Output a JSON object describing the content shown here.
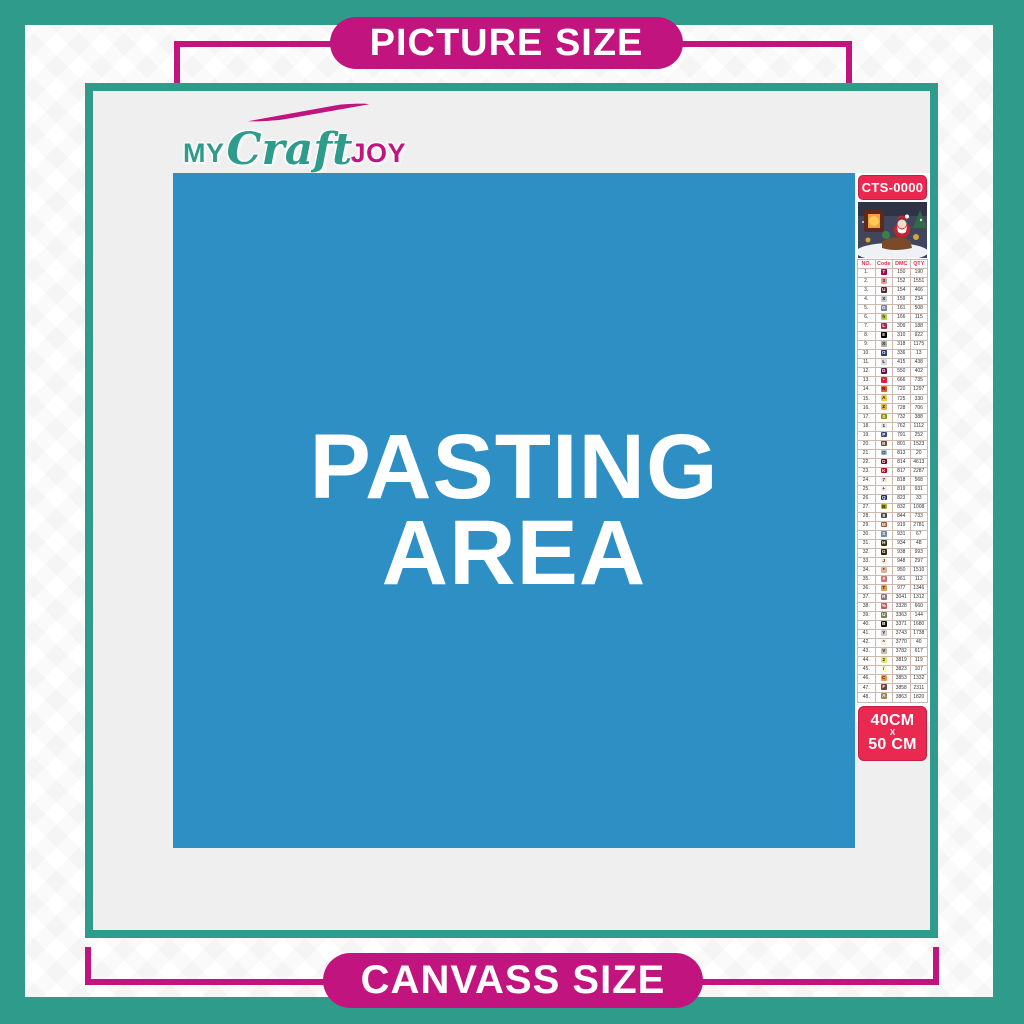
{
  "colors": {
    "teal": "#2F9B8B",
    "magenta": "#C2147E",
    "blue": "#2E8FC5",
    "red": "#E9294F",
    "canvas_gray": "#EFEFEF"
  },
  "banner_top": {
    "label": "PICTURE SIZE"
  },
  "banner_bottom": {
    "label": "CANVASS SIZE"
  },
  "logo": {
    "my": "MY",
    "craft": "Craft",
    "joy": "JOY"
  },
  "pasting": {
    "line1": "PASTING",
    "line2": "AREA"
  },
  "sidebar": {
    "sku": "CTS-0000",
    "size": {
      "width": "40CM",
      "sep": "X",
      "height": "50 CM"
    },
    "table": {
      "headers": [
        "NO.",
        "Code",
        "DMC",
        "QTY"
      ],
      "rows": [
        [
          "1.",
          "T",
          "#AB0249",
          "#ffffff",
          "150",
          "190"
        ],
        [
          "2.",
          "3",
          "#E2A099",
          "#222222",
          "152",
          "1551"
        ],
        [
          "3.",
          "U",
          "#572433",
          "#ffffff",
          "154",
          "466"
        ],
        [
          "4.",
          "X",
          "#C7CAD7",
          "#222222",
          "159",
          "234"
        ],
        [
          "5.",
          "G",
          "#7880A4",
          "#ffffff",
          "161",
          "508"
        ],
        [
          "6.",
          "h",
          "#C0C840",
          "#222222",
          "166",
          "115"
        ],
        [
          "7.",
          "L",
          "#9B2D4F",
          "#ffffff",
          "309",
          "188"
        ],
        [
          "8.",
          "E",
          "#000000",
          "#ffffff",
          "310",
          "922"
        ],
        [
          "9.",
          "X",
          "#ABABAB",
          "#222222",
          "318",
          "1175"
        ],
        [
          "10.",
          "O",
          "#253B73",
          "#ffffff",
          "336",
          "13"
        ],
        [
          "11.",
          "L",
          "#D9D9DE",
          "#222222",
          "415",
          "438"
        ],
        [
          "12.",
          "D",
          "#5C184E",
          "#ffffff",
          "550",
          "402"
        ],
        [
          "13.",
          "•",
          "#E31C3D",
          "#ffffff",
          "666",
          "735"
        ],
        [
          "14.",
          "N",
          "#E55C1F",
          "#222222",
          "720",
          "1297"
        ],
        [
          "15.",
          "A",
          "#F2C641",
          "#222222",
          "725",
          "330"
        ],
        [
          "16.",
          "Z",
          "#E4B04A",
          "#222222",
          "728",
          "706"
        ],
        [
          "17.",
          "S",
          "#948C10",
          "#ffffff",
          "732",
          "388"
        ],
        [
          "18.",
          "1",
          "#E6E6E9",
          "#222222",
          "762",
          "1112"
        ],
        [
          "19.",
          "P",
          "#39477F",
          "#ffffff",
          "791",
          "252"
        ],
        [
          "20.",
          "B",
          "#65452D",
          "#ffffff",
          "801",
          "1523"
        ],
        [
          "21.",
          "@",
          "#A0C3D9",
          "#222222",
          "813",
          "20"
        ],
        [
          "22.",
          "D",
          "#7B001B",
          "#ffffff",
          "814",
          "4613"
        ],
        [
          "23.",
          "K",
          "#BB051F",
          "#ffffff",
          "817",
          "2287"
        ],
        [
          "24.",
          "7",
          "#FDDFDB",
          "#222222",
          "818",
          "568"
        ],
        [
          "25.",
          "+",
          "#F8E7E7",
          "#222222",
          "819",
          "931"
        ],
        [
          "26.",
          "Q",
          "#213063",
          "#ffffff",
          "823",
          "33"
        ],
        [
          "27.",
          "B",
          "#BD9B33",
          "#222222",
          "832",
          "1008"
        ],
        [
          "28.",
          "8",
          "#484848",
          "#ffffff",
          "844",
          "733"
        ],
        [
          "29.",
          "M",
          "#A65233",
          "#ffffff",
          "919",
          "2781"
        ],
        [
          "30.",
          "S",
          "#6A8BA3",
          "#ffffff",
          "931",
          "67"
        ],
        [
          "31.",
          "H",
          "#313919",
          "#ffffff",
          "934",
          "48"
        ],
        [
          "32.",
          "G",
          "#36220C",
          "#ffffff",
          "938",
          "993"
        ],
        [
          "33.",
          "J",
          "#FEE9DA",
          "#222222",
          "948",
          "297"
        ],
        [
          "34.",
          "*",
          "#E0B094",
          "#222222",
          "950",
          "1510"
        ],
        [
          "35.",
          "#",
          "#CF7373",
          "#ffffff",
          "961",
          "112"
        ],
        [
          "36.",
          "T",
          "#DC9C56",
          "#222222",
          "977",
          "1346"
        ],
        [
          "37.",
          "R",
          "#956F7C",
          "#ffffff",
          "3041",
          "1312"
        ],
        [
          "38.",
          "%",
          "#C65A5A",
          "#ffffff",
          "3328",
          "660"
        ],
        [
          "39.",
          "U",
          "#728256",
          "#ffffff",
          "3363",
          "144"
        ],
        [
          "40.",
          "B",
          "#1E1108",
          "#ffffff",
          "3371",
          "1680"
        ],
        [
          "41.",
          "Y",
          "#D7CBD3",
          "#222222",
          "3743",
          "1738"
        ],
        [
          "42.",
          "^",
          "#FBEEE3",
          "#222222",
          "3770",
          "40"
        ],
        [
          "43.",
          "V",
          "#D2BCA6",
          "#222222",
          "3782",
          "617"
        ],
        [
          "44.",
          "2",
          "#E0E868",
          "#222222",
          "3819",
          "119"
        ],
        [
          "45.",
          "/",
          "#FDFDCD",
          "#222222",
          "3823",
          "107"
        ],
        [
          "46.",
          "C",
          "#F29746",
          "#222222",
          "3853",
          "1332"
        ],
        [
          "47.",
          "F",
          "#744240",
          "#ffffff",
          "3858",
          "2311"
        ],
        [
          "48.",
          "A",
          "#A4835C",
          "#ffffff",
          "3863",
          "1820"
        ]
      ]
    }
  }
}
